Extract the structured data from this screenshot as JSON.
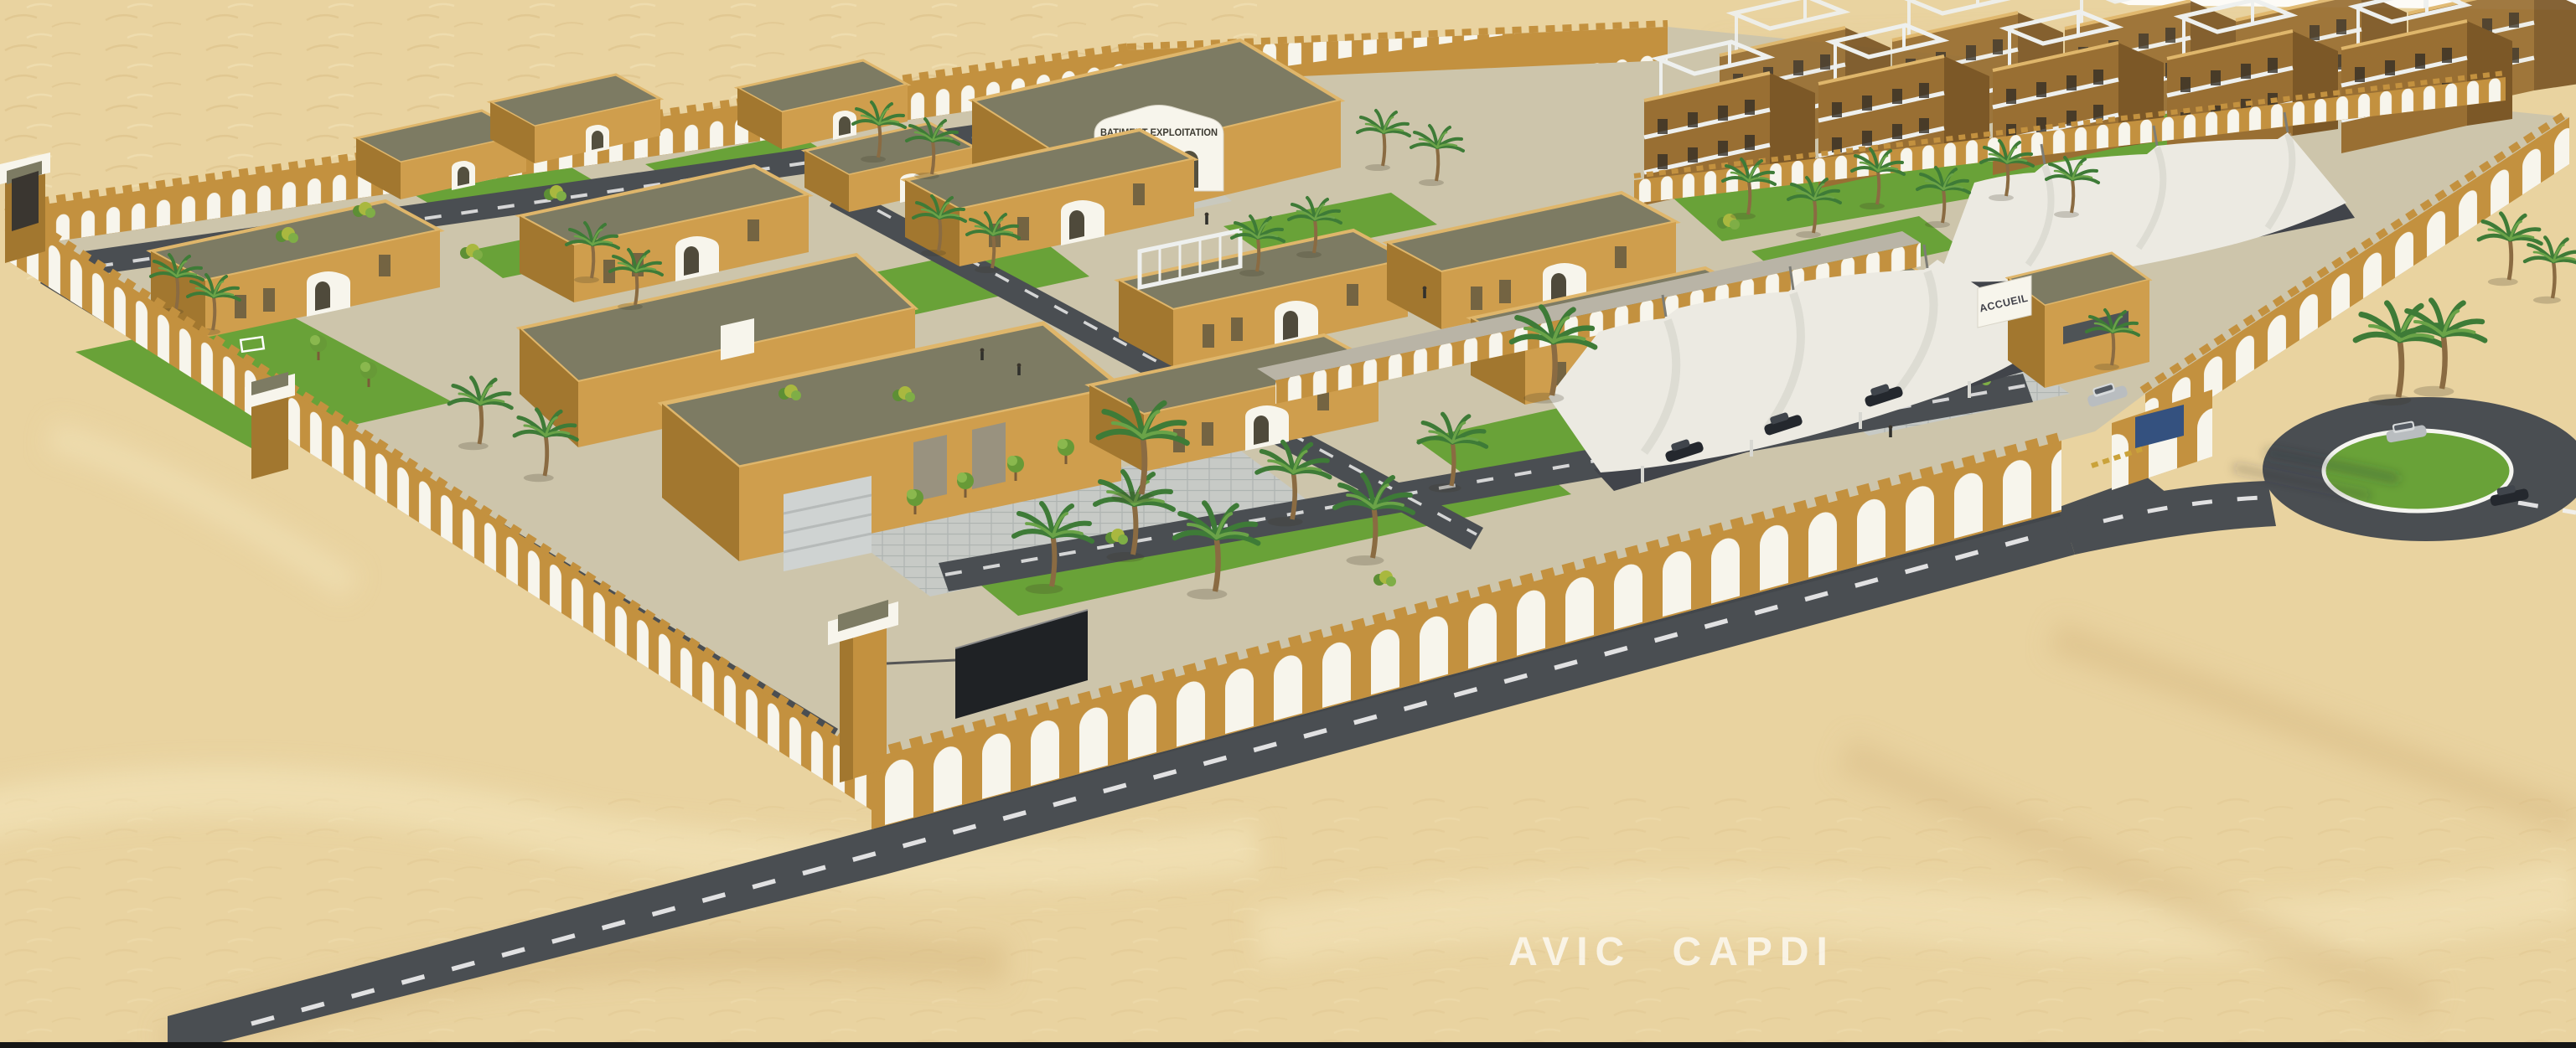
{
  "scene": {
    "description": "Aerial 3D architectural rendering of a walled desert compound: arcaded ochre perimeter walls, flat-roofed sand-colored buildings, white shade canopies, palm trees, lawns, internal roads, an entrance gate and a roundabout amid sand dunes.",
    "watermark": "AVIC CAPDI"
  },
  "signs": {
    "admin_building": "BATIMENT EXPLOITATION",
    "entrance_gate": "ACCUEIL"
  },
  "colors": {
    "sand": "#e9d3a0",
    "sand_light": "#f4e6bc",
    "sand_dark": "#d7b981",
    "ground": "#cdc5ab",
    "wall": "#c3913f",
    "wall_face": "#cf9e4d",
    "wall_dark": "#a2772f",
    "wall_light": "#dfb66b",
    "roof": "#7d7b63",
    "lawn": "#69a238",
    "lawn_dark": "#4e8a2b",
    "road": "#4a4e52",
    "paving": "#c7cac6",
    "paving_line": "#aeb4b1",
    "white": "#f7f5ec",
    "tent": "#eceae2",
    "tent_shade": "#c9c8bf",
    "shadow": "#41444a",
    "res": "#996f33",
    "res_dark": "#7c5827",
    "frame": "#eef0ee",
    "palm": "#3e7b37",
    "palm_light": "#6aa348",
    "trunk": "#8a6b42",
    "car_dark": "#24282e",
    "car_silver": "#b9bdc0",
    "plaque": "#34517f",
    "text_dark": "#3c3a31",
    "watermark_color": "#ffffff",
    "bar": "#161616"
  }
}
